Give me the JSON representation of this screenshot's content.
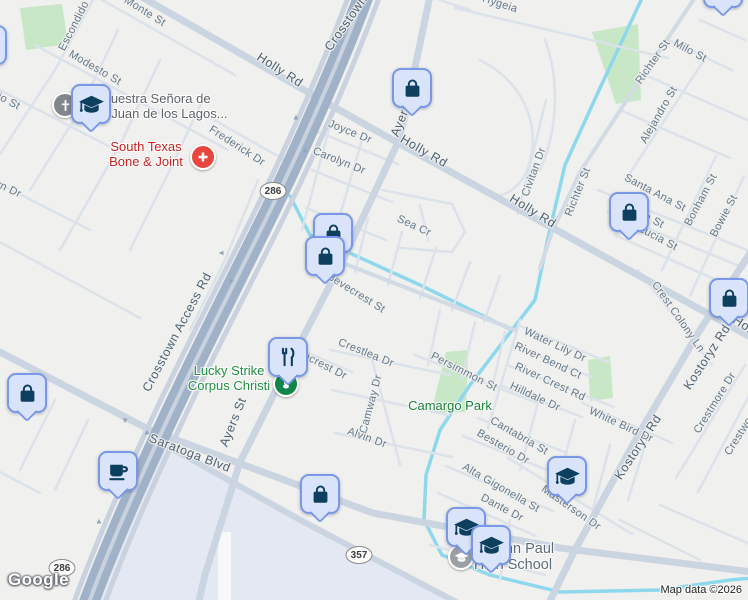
{
  "branding": {
    "logo": "Google",
    "attribution": "Map data ©2026"
  },
  "shields": [
    {
      "label": "286",
      "x": 273,
      "y": 191
    },
    {
      "label": "286",
      "x": 62,
      "y": 568
    },
    {
      "label": "357",
      "x": 359,
      "y": 555
    }
  ],
  "streets": [
    {
      "t": "Crosstown",
      "x": 346,
      "y": 23,
      "r": -55,
      "c": "M"
    },
    {
      "t": "Crosstown Access Rd",
      "x": 177,
      "y": 332,
      "r": -62,
      "c": "M"
    },
    {
      "t": "Holly Rd",
      "x": 280,
      "y": 70,
      "r": 33,
      "c": "M"
    },
    {
      "t": "Holly Rd",
      "x": 424,
      "y": 151,
      "r": 30,
      "c": "M"
    },
    {
      "t": "Holly Rd",
      "x": 533,
      "y": 211,
      "r": 32,
      "c": "M"
    },
    {
      "t": "Holly Rd",
      "x": 756,
      "y": 333,
      "r": 33,
      "c": "M"
    },
    {
      "t": "Ayers St",
      "x": 404,
      "y": 112,
      "r": -68,
      "c": "M"
    },
    {
      "t": "Ayers St",
      "x": 233,
      "y": 422,
      "r": -68,
      "c": "M"
    },
    {
      "t": "Saratoga Blvd",
      "x": 190,
      "y": 453,
      "r": 21,
      "c": "M"
    },
    {
      "t": "Kostoryz Rd",
      "x": 707,
      "y": 357,
      "r": -57,
      "c": "M"
    },
    {
      "t": "Kostoryz Rd",
      "x": 638,
      "y": 447,
      "r": -57,
      "c": "M"
    },
    {
      "t": "Richter St",
      "x": 653,
      "y": 62,
      "r": -55,
      "c": "m"
    },
    {
      "t": "Richter St",
      "x": 578,
      "y": 192,
      "r": -68,
      "c": "m"
    },
    {
      "t": "El Monte St",
      "x": 139,
      "y": 8,
      "r": 32,
      "c": "m"
    },
    {
      "t": "Escondido",
      "x": 74,
      "y": 26,
      "r": -63,
      "c": "m"
    },
    {
      "t": "Modesto St",
      "x": 95,
      "y": 68,
      "r": 30,
      "c": "m"
    },
    {
      "t": "Frio St",
      "x": 4,
      "y": 99,
      "r": 28,
      "c": "m"
    },
    {
      "t": "yn Dr",
      "x": 8,
      "y": 189,
      "r": 25,
      "c": "m"
    },
    {
      "t": "Frederick Dr",
      "x": 237,
      "y": 146,
      "r": 33,
      "c": "m"
    },
    {
      "t": "Joyce Dr",
      "x": 350,
      "y": 132,
      "r": 22,
      "c": "m"
    },
    {
      "t": "Carolyn Dr",
      "x": 339,
      "y": 161,
      "r": 22,
      "c": "m"
    },
    {
      "t": "Sea Cr",
      "x": 414,
      "y": 226,
      "r": 25,
      "c": "m"
    },
    {
      "t": "Bevecrest St",
      "x": 356,
      "y": 293,
      "r": 32,
      "c": "m"
    },
    {
      "t": "Crestlea Dr",
      "x": 366,
      "y": 353,
      "r": 22,
      "c": "m"
    },
    {
      "t": "ncrest Dr",
      "x": 325,
      "y": 366,
      "r": 27,
      "c": "m"
    },
    {
      "t": "Camway Dr",
      "x": 371,
      "y": 404,
      "r": -75,
      "c": "m"
    },
    {
      "t": "Persimmon St",
      "x": 464,
      "y": 372,
      "r": 27,
      "c": "m"
    },
    {
      "t": "Alvin Dr",
      "x": 367,
      "y": 438,
      "r": 20,
      "c": "m"
    },
    {
      "t": "Water Lily Dr",
      "x": 555,
      "y": 345,
      "r": 25,
      "c": "m"
    },
    {
      "t": "River Bend Ct",
      "x": 548,
      "y": 361,
      "r": 25,
      "c": "m"
    },
    {
      "t": "River Crest Rd",
      "x": 550,
      "y": 382,
      "r": 25,
      "c": "m"
    },
    {
      "t": "Hilldale Dr",
      "x": 535,
      "y": 397,
      "r": 25,
      "c": "m"
    },
    {
      "t": "Cantabria St",
      "x": 519,
      "y": 436,
      "r": 30,
      "c": "m"
    },
    {
      "t": "Besterio Dr",
      "x": 503,
      "y": 447,
      "r": 30,
      "c": "m"
    },
    {
      "t": "Alta Gigonella St",
      "x": 501,
      "y": 488,
      "r": 30,
      "c": "m"
    },
    {
      "t": "Dante Dr",
      "x": 502,
      "y": 508,
      "r": 28,
      "c": "m"
    },
    {
      "t": "Masterson Dr",
      "x": 571,
      "y": 508,
      "r": 35,
      "c": "m"
    },
    {
      "t": "White Bird Dr",
      "x": 621,
      "y": 425,
      "r": 25,
      "c": "m"
    },
    {
      "t": "Crest Colony Ln",
      "x": 678,
      "y": 317,
      "r": 55,
      "c": "m"
    },
    {
      "t": "Santa Ana St",
      "x": 655,
      "y": 193,
      "r": 28,
      "c": "m"
    },
    {
      "t": "Sofia St",
      "x": 645,
      "y": 216,
      "r": 28,
      "c": "m"
    },
    {
      "t": "Lucia St",
      "x": 658,
      "y": 238,
      "r": 28,
      "c": "m"
    },
    {
      "t": "Bonham St",
      "x": 701,
      "y": 200,
      "r": -62,
      "c": "m"
    },
    {
      "t": "Bowie St",
      "x": 724,
      "y": 216,
      "r": -62,
      "c": "m"
    },
    {
      "t": "Milo St",
      "x": 690,
      "y": 51,
      "r": 28,
      "c": "m"
    },
    {
      "t": "Alejandro St",
      "x": 659,
      "y": 115,
      "r": -60,
      "c": "m"
    },
    {
      "t": "Hygeia",
      "x": 500,
      "y": 4,
      "r": 18,
      "c": "m"
    },
    {
      "t": "Civitan Dr",
      "x": 534,
      "y": 172,
      "r": -70,
      "c": "m"
    },
    {
      "t": "Crestmore Dr",
      "x": 715,
      "y": 403,
      "r": -58,
      "c": "m"
    },
    {
      "t": "Crestwood",
      "x": 742,
      "y": 431,
      "r": -58,
      "c": "m"
    }
  ],
  "pois": [
    {
      "name": "south-texas-bone-and-joint-label",
      "lines": [
        "South Texas",
        "Bone & Joint"
      ],
      "color": "red",
      "x": 146,
      "y": 140
    },
    {
      "name": "nuestra-senora-label",
      "lines": [
        "Nuestra Señora de",
        "San Juan de los Lagos..."
      ],
      "color": "dkgray",
      "x": 156,
      "y": 92
    },
    {
      "name": "lucky-strike-label",
      "lines": [
        "Lucky Strike",
        "Corpus Christi"
      ],
      "color": "green",
      "x": 229,
      "y": 364
    },
    {
      "name": "camargo-park-label",
      "lines": [
        "Camargo Park"
      ],
      "color": "green2",
      "x": 450,
      "y": 399
    },
    {
      "name": "st-john-paul-high-school-label",
      "lines": [
        "St John Paul",
        "High School"
      ],
      "color": "gray",
      "x": 513,
      "y": 541
    }
  ],
  "markers": [
    {
      "kind": "bag",
      "name": "shopping-bag-marker",
      "x": 412,
      "y": 88
    },
    {
      "kind": "bag",
      "name": "shopping-bag-marker",
      "x": 629,
      "y": 212
    },
    {
      "kind": "bag",
      "name": "shopping-bag-marker",
      "x": 729,
      "y": 298
    },
    {
      "kind": "bag",
      "name": "shopping-bag-marker",
      "x": 333,
      "y": 233
    },
    {
      "kind": "bag",
      "name": "shopping-bag-marker",
      "x": 325,
      "y": 256
    },
    {
      "kind": "bag",
      "name": "shopping-bag-marker",
      "x": 27,
      "y": 393
    },
    {
      "kind": "food",
      "name": "restaurant-marker",
      "x": 288,
      "y": 357
    },
    {
      "kind": "coffee",
      "name": "coffee-marker",
      "x": 118,
      "y": 471
    },
    {
      "kind": "bag",
      "name": "shopping-bag-marker",
      "x": 320,
      "y": 494
    },
    {
      "kind": "grad",
      "name": "school-marker",
      "x": 567,
      "y": 476
    },
    {
      "kind": "grad",
      "name": "school-marker",
      "x": 466,
      "y": 527
    },
    {
      "kind": "grad",
      "name": "school-marker",
      "x": 491,
      "y": 545
    },
    {
      "kind": "grad",
      "name": "school-marker",
      "x": 91,
      "y": 104
    },
    {
      "kind": "bag",
      "name": "shopping-bag-marker",
      "x": 723,
      "y": -12
    },
    {
      "kind": "bag",
      "name": "shopping-bag-marker",
      "x": -13,
      "y": 45
    }
  ],
  "poi_circles": [
    {
      "kind": "church",
      "name": "church-poi-icon",
      "x": 65,
      "y": 105,
      "color": "#82878d"
    },
    {
      "kind": "pin",
      "name": "bowling-poi-icon",
      "x": 286,
      "y": 384,
      "color": "#12864a"
    },
    {
      "kind": "school",
      "name": "school-poi-icon",
      "x": 461,
      "y": 557,
      "color": "#9aa0a6"
    },
    {
      "kind": "medical",
      "name": "hospital-poi-icon",
      "x": 203,
      "y": 157,
      "color": "#e8453c"
    }
  ],
  "arrows": [
    {
      "x": 296,
      "y": 117,
      "r": 0
    },
    {
      "x": 305,
      "y": 150,
      "r": 0
    },
    {
      "x": 221,
      "y": 253,
      "r": -90
    },
    {
      "x": 232,
      "y": 281,
      "r": 90
    },
    {
      "x": 125,
      "y": 421,
      "r": 180
    },
    {
      "x": 147,
      "y": 432,
      "r": 0
    },
    {
      "x": 99,
      "y": 521,
      "r": 0
    }
  ]
}
